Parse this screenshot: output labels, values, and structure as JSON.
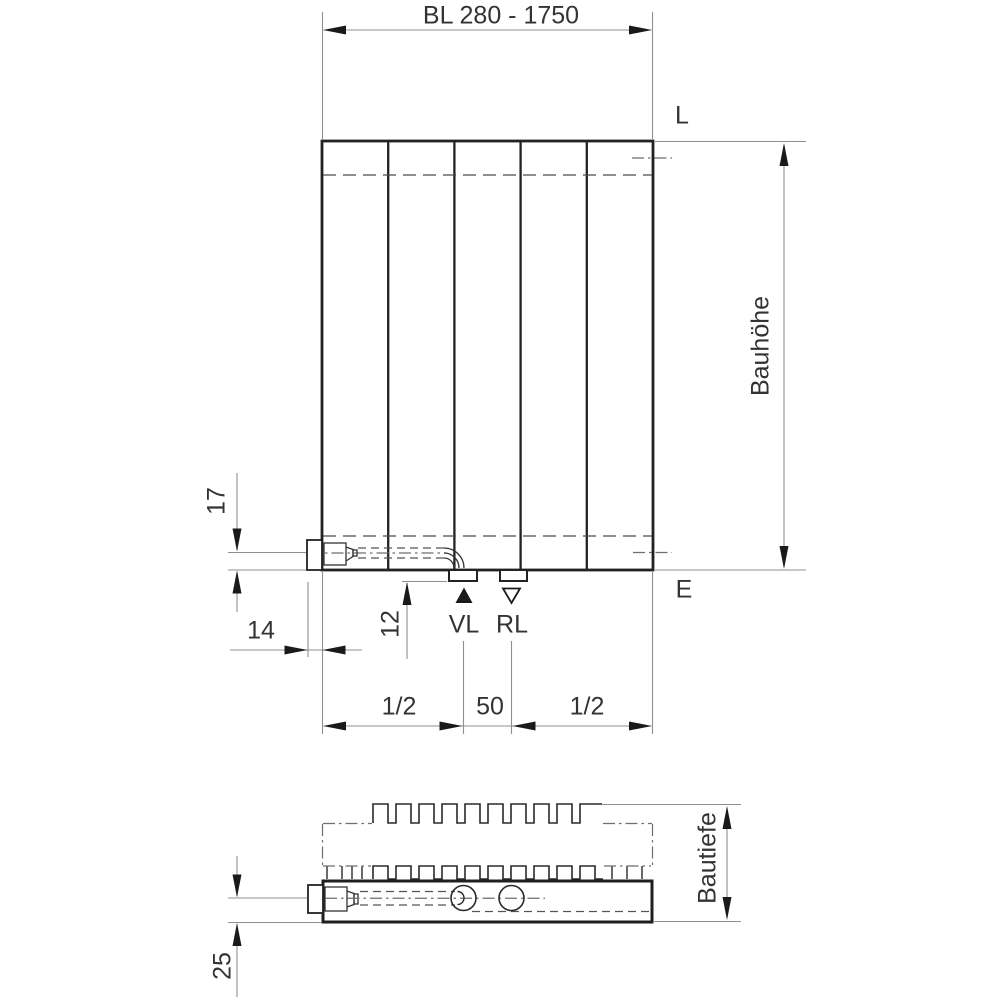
{
  "figure": {
    "type": "radiator technical dimension drawing",
    "background": "#ffffff",
    "drawing_line_color": "#222222",
    "dimension_line_color": "#8f8f8f",
    "text_color": "#333333"
  },
  "front_view": {
    "width_dim_label": "BL 280 - 1750",
    "height_dim_label": "Bauhöhe",
    "top_level_label": "L",
    "bottom_level_label": "E",
    "supply_label": "VL",
    "return_label": "RL",
    "valve_axis_offset_label": "17",
    "valve_protrusion_label": "14",
    "stub_height_label": "12",
    "left_span_label": "1/2",
    "center_span_label": "50",
    "right_span_label": "1/2"
  },
  "section_view": {
    "depth_dim_label": "Bautiefe",
    "pipe_axis_offset_label": "25"
  }
}
